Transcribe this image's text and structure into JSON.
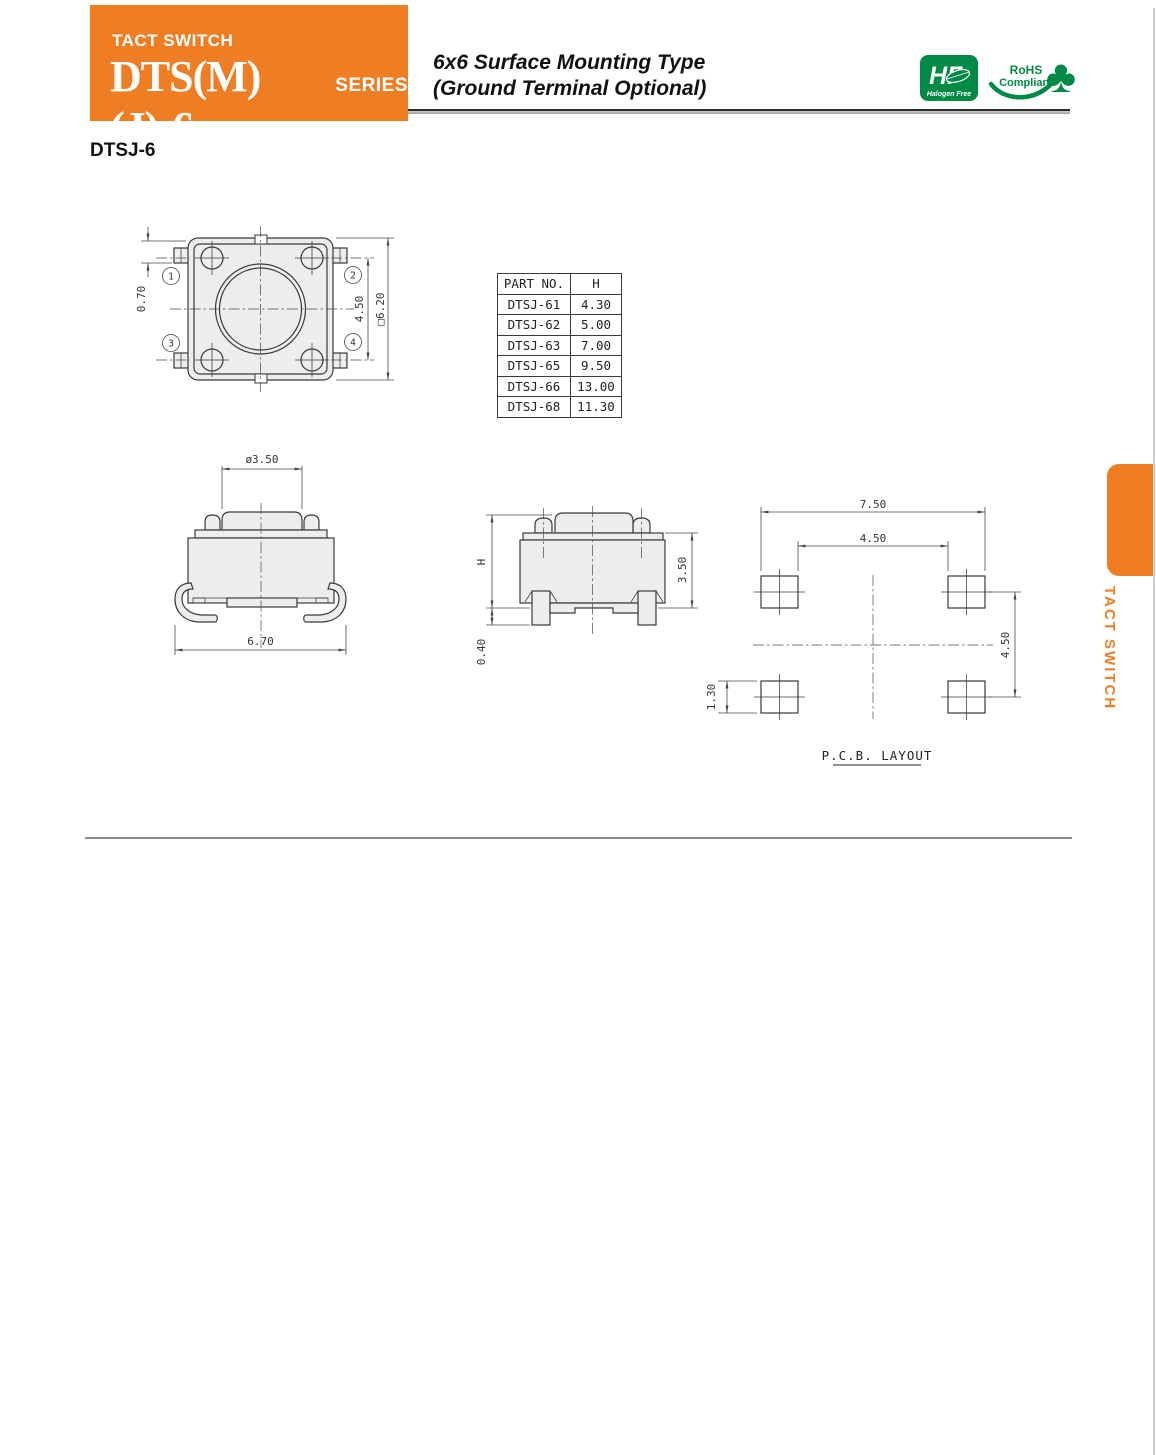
{
  "header": {
    "category": "TACT SWITCH",
    "series": "DTS(M)(J)-6",
    "series_suffix": "SERIES",
    "subtitle_line1": "6x6 Surface Mounting Type",
    "subtitle_line2": "(Ground Terminal Optional)"
  },
  "badges": {
    "halogen_free": {
      "monogram": "HF",
      "label": "Halogen Free"
    },
    "rohs": {
      "line1": "RoHS",
      "line2": "Compliant",
      "clover_icon": "♣"
    }
  },
  "section_title": "DTSJ-6",
  "side_tab": {
    "label": "TACT SWITCH"
  },
  "part_table": {
    "headers": [
      "PART NO.",
      "H"
    ],
    "rows": [
      [
        "DTSJ-61",
        "4.30"
      ],
      [
        "DTSJ-62",
        "5.00"
      ],
      [
        "DTSJ-63",
        "7.00"
      ],
      [
        "DTSJ-65",
        "9.50"
      ],
      [
        "DTSJ-66",
        "13.00"
      ],
      [
        "DTSJ-68",
        "11.30"
      ]
    ]
  },
  "top_view": {
    "dim_terminal_offset": "0.70",
    "dim_contact_pitch": "4.50",
    "dim_body": "□6.20",
    "terminals": [
      "1",
      "2",
      "3",
      "4"
    ]
  },
  "front_view": {
    "dim_stem": "ø3.50",
    "dim_width": "6.70"
  },
  "side_view": {
    "dim_height": "H",
    "dim_standoff": "0.40",
    "dim_body_height": "3.50"
  },
  "pcb_layout": {
    "dim_outer_span": "7.50",
    "dim_inner_span": "4.50",
    "dim_row_pitch": "4.50",
    "dim_pad_height": "1.30",
    "caption": "P.C.B. LAYOUT"
  },
  "colors": {
    "accent_orange": "#EE7D23",
    "logo_green": "#008A45",
    "drawing_line": "#3A3A3A",
    "drawing_fill": "#EDEDED"
  }
}
